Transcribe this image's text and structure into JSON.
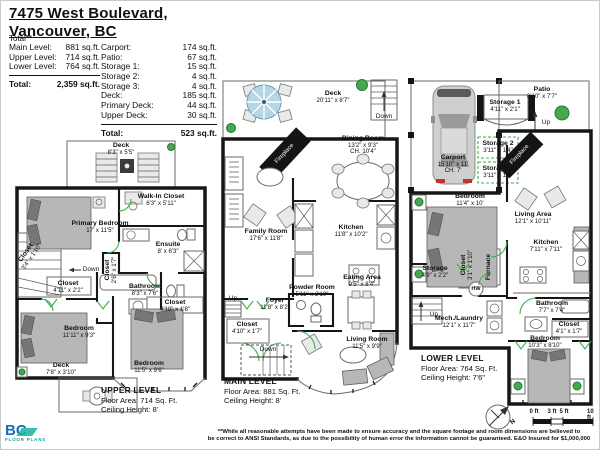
{
  "header": {
    "address_line1": "7475 West Boulevard,",
    "address_line2": "Vancouver, BC"
  },
  "summary": {
    "note": "Total**",
    "left_rows": [
      {
        "label": "Main Level:",
        "value": "881 sq.ft."
      },
      {
        "label": "Upper Level:",
        "value": "714 sq.ft."
      },
      {
        "label": "Lower Level:",
        "value": "764 sq.ft."
      }
    ],
    "left_total": {
      "label": "Total:",
      "value": "2,359 sq.ft."
    },
    "right_rows": [
      {
        "label": "Carport:",
        "value": "174 sq.ft."
      },
      {
        "label": "Patio:",
        "value": "67 sq.ft."
      },
      {
        "label": "Storage 1:",
        "value": "15 sq.ft."
      },
      {
        "label": "Storage 2:",
        "value": "4 sq.ft."
      },
      {
        "label": "Storage 3:",
        "value": "4 sq.ft."
      },
      {
        "label": "Deck:",
        "value": "185 sq.ft."
      },
      {
        "label": "Primary Deck:",
        "value": "44 sq.ft."
      },
      {
        "label": "Upper Deck:",
        "value": "30 sq.ft."
      }
    ],
    "right_total": {
      "label": "Total:",
      "value": "523 sq.ft."
    }
  },
  "upper": {
    "caption": {
      "title": "UPPER LEVEL",
      "area": "Floor Area: 714 Sq. Ft.",
      "ceiling": "Ceiling Height: 8'"
    },
    "rooms": {
      "deck_top": {
        "name": "Deck",
        "dims": "8'3\" x 5'5\""
      },
      "primary_bedroom": {
        "name": "Primary Bedroom",
        "dims": "17' x 11'5\""
      },
      "walk_in_closet": {
        "name": "Walk-In Closet",
        "dims": "6'3\" x 5'11\""
      },
      "ensuite": {
        "name": "Ensuite",
        "dims": "8' x 6'3\""
      },
      "closet_stairs": {
        "name": "Closet",
        "dims": "3'4\" x 1'10\""
      },
      "closet_hall": {
        "name": "Closet",
        "dims": "4'11\" x 2'2\""
      },
      "bathroom": {
        "name": "Bathroom",
        "dims": "8'3\" x 7'6\""
      },
      "closet_side": {
        "name": "Closet",
        "dims": "2'6\" x 1'7\""
      },
      "closet_bed": {
        "name": "Closet",
        "dims": "4'10\" x 1'8\""
      },
      "bedroom_left": {
        "name": "Bedroom",
        "dims": "11'11\" x 9'3\""
      },
      "bedroom_bottom": {
        "name": "Bedroom",
        "dims": "11'5\" x 9'6\""
      },
      "deck_bottom": {
        "name": "Deck",
        "dims": "7'8\" x 3'10\""
      }
    },
    "labels": {
      "down": "Down"
    }
  },
  "main": {
    "caption": {
      "title": "MAIN LEVEL",
      "area": "Floor Area: 881 Sq. Ft.",
      "ceiling": "Ceiling Height: 8'"
    },
    "rooms": {
      "deck": {
        "name": "Deck",
        "dims": "20'11\" x 8'7\""
      },
      "dining": {
        "name": "Dining Room",
        "dims": "13'2\" x 9'3\"",
        "extra": "CH. 10'4\""
      },
      "family": {
        "name": "Family Room",
        "dims": "17'6\" x 11'8\""
      },
      "kitchen": {
        "name": "Kitchen",
        "dims": "11'8\" x 10'2\""
      },
      "eating": {
        "name": "Eating Area",
        "dims": "9'5\" x 8'4\""
      },
      "powder": {
        "name": "Powder Room",
        "dims": "5'11\" x 2'10\""
      },
      "foyer": {
        "name": "Foyer",
        "dims": "11'8\" x 8'2\""
      },
      "closet": {
        "name": "Closet",
        "dims": "4'10\" x 1'7\""
      },
      "living": {
        "name": "Living Room",
        "dims": "11'5\" x 9'9\""
      }
    },
    "labels": {
      "down_deck": "Down",
      "down_stairs": "Down",
      "up": "Up",
      "fireplace": "Fireplace"
    }
  },
  "lower": {
    "caption": {
      "title": "LOWER LEVEL",
      "area": "Floor Area: 764 Sq. Ft.",
      "ceiling": "Ceiling Height: 7'6\""
    },
    "rooms": {
      "carport": {
        "name": "Carport",
        "dims": "15'10\" x 11'",
        "extra": "CH. 7'"
      },
      "patio": {
        "name": "Patio",
        "dims": "8'10\" x 7'7\""
      },
      "storage1": {
        "name": "Storage 1",
        "dims": "4'11\" x 2'1\""
      },
      "storage2": {
        "name": "Storage 2",
        "dims": "3'11\" x 1'4\""
      },
      "storage3": {
        "name": "Storage 3",
        "dims": "3'11\" x 1'4\""
      },
      "living": {
        "name": "Living Area",
        "dims": "12'1\" x 10'11\""
      },
      "bedroom_upper": {
        "name": "Bedroom",
        "dims": "11'4\" x 10'"
      },
      "kitchen": {
        "name": "Kitchen",
        "dims": "7'11\" x 7'11\""
      },
      "storage": {
        "name": "Storage",
        "dims": "4'9\" x 2'2\""
      },
      "closet_side": {
        "name": "Closet",
        "dims": "3'1\" x 1'10\""
      },
      "mech": {
        "name": "Mech./Laundry",
        "dims": "12'1\" x 11'7\""
      },
      "bathroom": {
        "name": "Bathroom",
        "dims": "7'7\" x 7'4\""
      },
      "closet": {
        "name": "Closet",
        "dims": "4'1\" x 1'7\""
      },
      "bedroom_lower": {
        "name": "Bedroom",
        "dims": "10'3\" x 8'10\""
      }
    },
    "labels": {
      "up_patio": "Up",
      "up_stairs": "Up",
      "fireplace": "Fireplace",
      "furnace": "Furnace",
      "hw": "HW"
    }
  },
  "compass": {
    "label": "N"
  },
  "scale_bar": {
    "ticks": [
      "0 ft",
      "3 ft",
      "5 ft",
      "10 ft"
    ]
  },
  "disclaimer": {
    "line1": "**While all reasonable attempts have been made to ensure accuracy and the square footage and room dimensions are believed to",
    "line2": "be correct to ANSI Standards, as due to the possibility of human error the information cannot be guaranteed. E&O Insured for $1,000,000"
  },
  "logo": {
    "name": "BC",
    "sub": "FLOOR PLANS"
  },
  "colors": {
    "wall": "#161616",
    "accent_green": "#3fae4a",
    "furniture": "#b7b7b7",
    "umbrella_blue": "#b5d6e4",
    "logo_blue": "#1b6cb3",
    "logo_teal": "#17b3a6"
  }
}
